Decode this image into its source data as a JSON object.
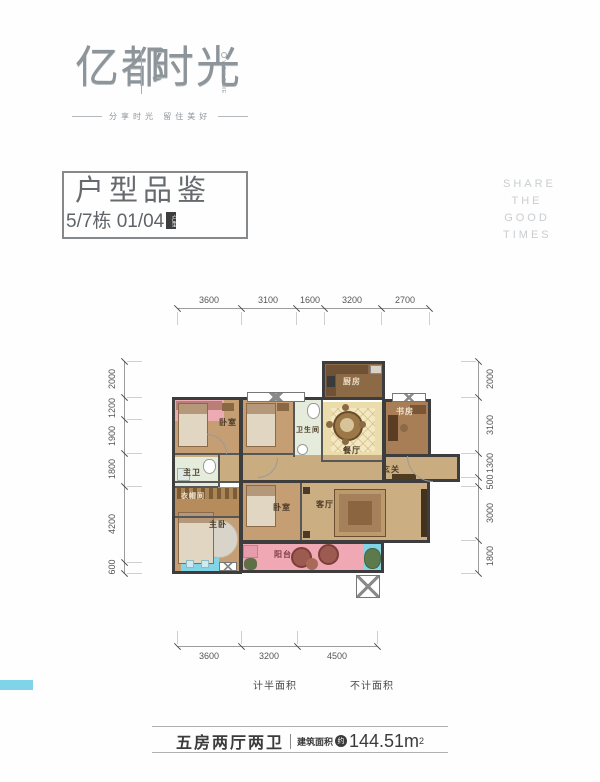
{
  "brand": {
    "name_left": "亿都",
    "name_right": "时光",
    "name_sub": "YIDU TIME",
    "tagline": "分享时光 留住美好"
  },
  "header": {
    "title": "户型品鉴",
    "subtitle": "5/7栋 01/04",
    "seal": "户型",
    "slogan": [
      "SHARE",
      "THE",
      "GOOD",
      "TIMES"
    ]
  },
  "floorplan": {
    "rooms": {
      "kitchen": "厨房",
      "study": "书房",
      "bedroom_a": "卧室",
      "bathroom": "卫生间",
      "dining": "餐厅",
      "foyer": "玄关",
      "master_bath": "主卫",
      "cloakroom": "衣帽间",
      "master_bedroom": "主卧",
      "bedroom_b": "卧室",
      "living": "客厅",
      "balcony": "阳台"
    },
    "dims_top": [
      "3600",
      "3100",
      "1600",
      "3200",
      "2700"
    ],
    "dims_bottom": [
      "3600",
      "3200",
      "4500"
    ],
    "dims_left": [
      "2000",
      "1200",
      "1900",
      "1800",
      "4200",
      "600"
    ],
    "dims_right": [
      "2000",
      "3100",
      "1300",
      "500",
      "3000",
      "1800"
    ],
    "palette": {
      "wall": "#3d3d3d",
      "wood_light": "#c59e73",
      "wood_mid": "#c9ac80",
      "wood_dark": "#8d6a46",
      "cream": "#eadcab",
      "tile": "#e6ecdb",
      "half_area_pink": "#f0a9b4",
      "no_count_blue": "#82d5e7"
    }
  },
  "legend": [
    {
      "label": "计半面积",
      "color": "#f3b7c3",
      "style": "background:#f3b7c3"
    },
    {
      "label": "不计面积",
      "color": "#7fd4e8",
      "style": "background:#7fd4e8"
    }
  ],
  "footer": {
    "layout": "五房两厅两卫",
    "area_label": "建筑面积",
    "area_prefix": "约",
    "area_value": "144.51",
    "area_unit": "m",
    "area_exp": "2"
  }
}
